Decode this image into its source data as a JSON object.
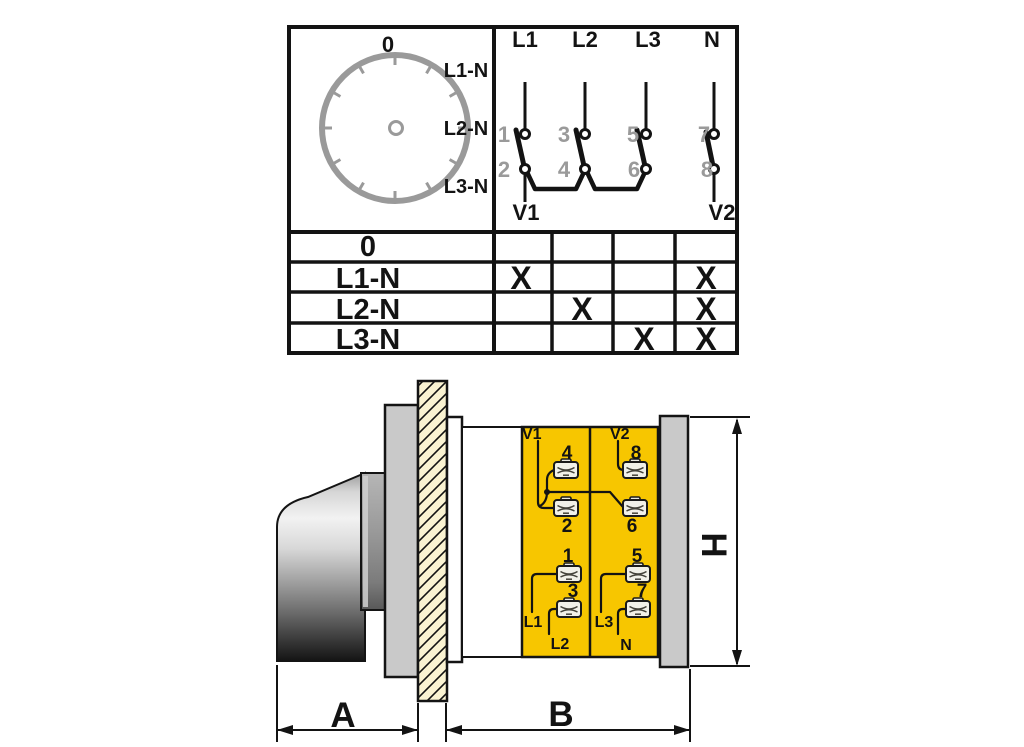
{
  "colors": {
    "accent_yellow": "#F7C600",
    "schematic_gray": "#9A9A9A",
    "metal_gray": "#C9C9C9",
    "panel_cream": "#FAF3D2",
    "outline_black": "#131313"
  },
  "position_diagram": {
    "dial": {
      "top_label": "0",
      "side_labels": [
        "L1-N",
        "L2-N",
        "L3-N"
      ]
    },
    "schematic": {
      "input_terminals": [
        "L1",
        "L2",
        "L3",
        "N"
      ],
      "upper_contacts": [
        "1",
        "3",
        "5",
        "7"
      ],
      "lower_contacts": [
        "2",
        "4",
        "6",
        "8"
      ],
      "outputs": [
        "V1",
        "V2"
      ]
    }
  },
  "truth_table": {
    "rows": [
      {
        "label": "0",
        "marks": [
          "",
          "",
          "",
          ""
        ]
      },
      {
        "label": "L1-N",
        "marks": [
          "X",
          "",
          "",
          "X"
        ]
      },
      {
        "label": "L2-N",
        "marks": [
          "",
          "X",
          "",
          "X"
        ]
      },
      {
        "label": "L3-N",
        "marks": [
          "",
          "",
          "X",
          "X"
        ]
      }
    ]
  },
  "side_view": {
    "output_labels": {
      "v1": "V1",
      "v2": "V2"
    },
    "terminal_numbers": {
      "t1": "1",
      "t2": "2",
      "t3": "3",
      "t4": "4",
      "t5": "5",
      "t6": "6",
      "t7": "7",
      "t8": "8"
    },
    "input_labels": {
      "l1": "L1",
      "l2": "L2",
      "l3": "L3",
      "n": "N"
    },
    "dimensions": {
      "front_depth": "A",
      "body_depth": "B",
      "height": "H"
    }
  }
}
